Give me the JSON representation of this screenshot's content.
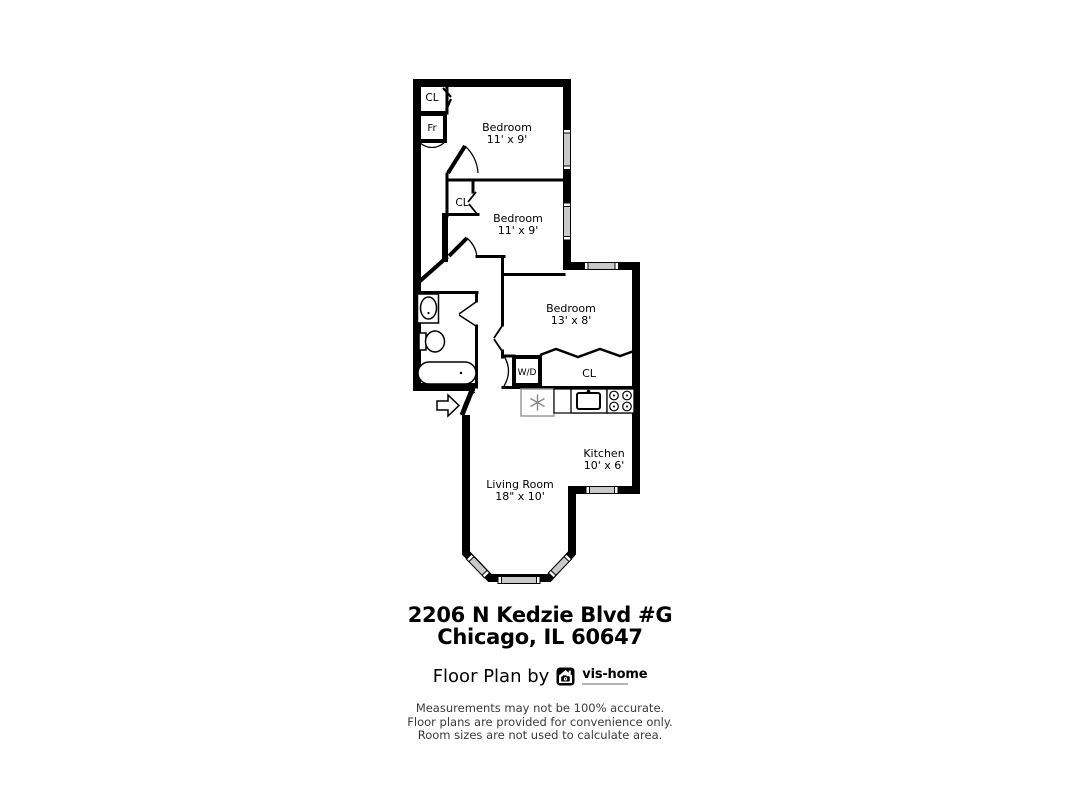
{
  "plan": {
    "rooms": [
      {
        "name": "Bedroom",
        "dims": "11' x 9'"
      },
      {
        "name": "Bedroom",
        "dims": "11' x 9'"
      },
      {
        "name": "Bedroom",
        "dims": "13' x 8'"
      },
      {
        "name": "Kitchen",
        "dims": "10' x 6'"
      },
      {
        "name": "Living Room",
        "dims": "18\" x 10'"
      }
    ],
    "fixtures": {
      "closet_top": "CL",
      "fridge_closet": "Fr",
      "bedroom2_closet": "CL",
      "washer_dryer": "W/D",
      "hall_closet": "CL"
    },
    "colors": {
      "wall": "#000000",
      "window_glass": "#c9c9c9",
      "appliance_gray": "#888888"
    }
  },
  "address": {
    "line1": "2206 N Kedzie Blvd #G",
    "line2": "Chicago, IL 60647"
  },
  "footer": {
    "byline": "Floor Plan by",
    "logo_text": "vis-home"
  },
  "disclaimer": {
    "line1": "Measurements may not be 100% accurate.",
    "line2": "Floor plans are provided for convenience only.",
    "line3": "Room sizes are not used to calculate area."
  }
}
